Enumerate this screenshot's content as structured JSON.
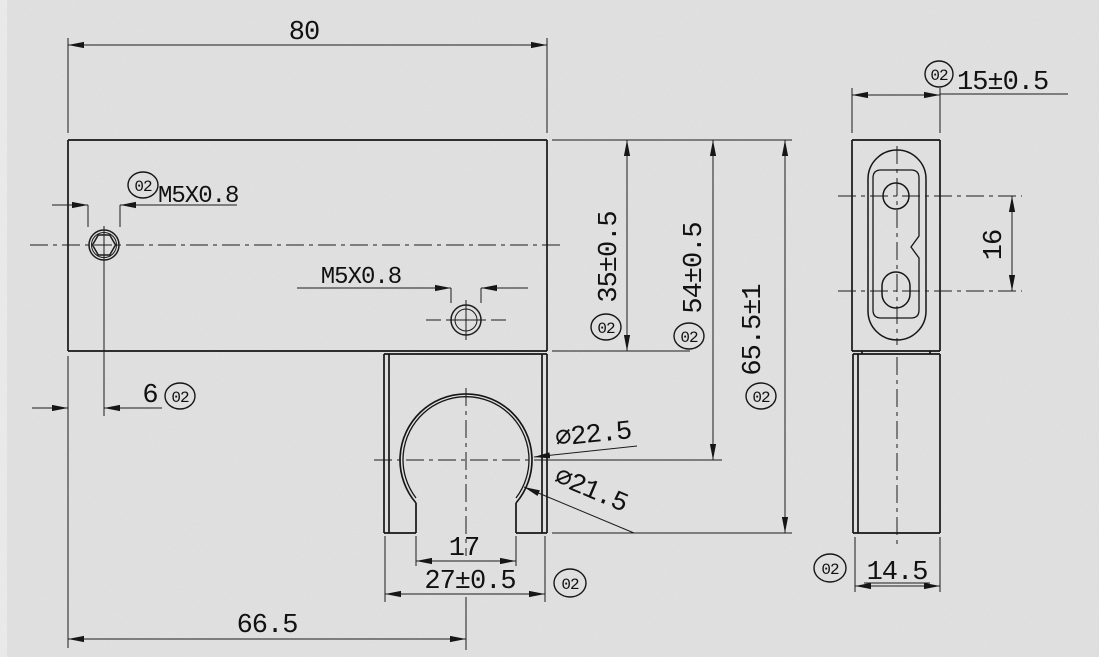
{
  "drawing": {
    "badge": "02",
    "colors": {
      "background": "#e9e9e9",
      "line": "#161616",
      "left_strip": "#f3f3f3"
    },
    "front": {
      "width": "80",
      "edge_to_thread": "6",
      "thread_left": "M5X0.8",
      "thread_mid": "M5X0.8",
      "block_height": "35±0.5",
      "top_to_bore": "54±0.5",
      "overall_height": "65.5±1",
      "bore_outer": "⌀22.5",
      "bore_inner": "⌀21.5",
      "slot_width": "17",
      "clamp_width": "27±0.5",
      "edge_to_bore": "66.5"
    },
    "side": {
      "width": "15±0.5",
      "hole_spacing": "16",
      "lower_width": "14.5"
    }
  }
}
